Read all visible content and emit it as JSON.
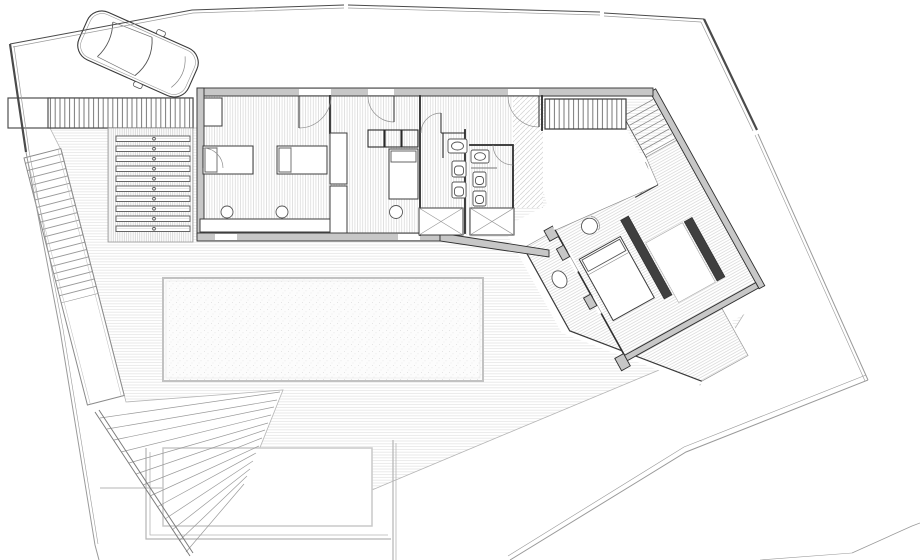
{
  "meta": {
    "drawing_type": "architectural floor plan — villa site plan, top view, no text labels"
  },
  "colors": {
    "wall_fill": "#c7c7c7",
    "wall_edge": "#2f2f2f",
    "partition": "#2a2a2a",
    "boundary": "#4a4a4a",
    "boundary_thin": "#9a9a9a",
    "fixture": "#555555",
    "furniture_dark": "#3f3f3f",
    "pool_border": "#c2c2c2",
    "deck_line": "#e4e4e4",
    "floor_line": "#d9d9d9"
  },
  "site": {
    "elements": [
      "site-boundary",
      "driveway",
      "parked-car",
      "slatted-grate",
      "louvered-lightwell",
      "timber-deck",
      "swimming-pool",
      "sunken-patio",
      "perimeter-stair-upper",
      "garden-stair-lower",
      "road-edge-lines"
    ]
  },
  "building": {
    "rooms": [
      {
        "id": "bedroom-1",
        "furniture": [
          "single-bed",
          "single-bed",
          "desk",
          "stool",
          "stool",
          "closet"
        ]
      },
      {
        "id": "bedroom-2",
        "furniture": [
          "single-bed",
          "closet-row",
          "stool"
        ]
      },
      {
        "id": "bathroom-1",
        "fixtures": [
          "sink",
          "toilet",
          "bidet",
          "shower"
        ]
      },
      {
        "id": "bathroom-2",
        "fixtures": [
          "sink",
          "toilet",
          "bidet",
          "shower"
        ]
      },
      {
        "id": "entry-hall",
        "features": [
          "entry-door",
          "slatted-stair",
          "diagonal-stair"
        ]
      },
      {
        "id": "master-bedroom",
        "furniture": [
          "double-bed",
          "wardrobe-bar",
          "wardrobe-bar",
          "armchair"
        ]
      },
      {
        "id": "master-terrace",
        "furniture": [
          "round-table"
        ]
      }
    ]
  }
}
